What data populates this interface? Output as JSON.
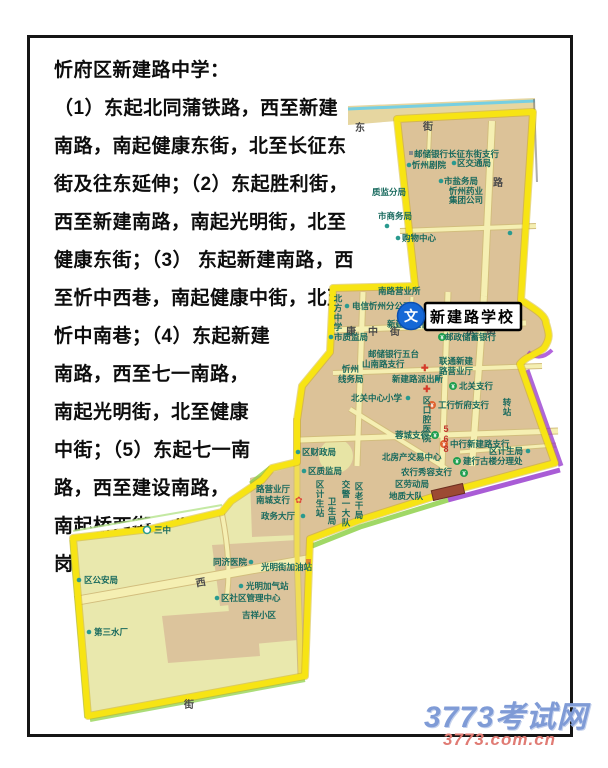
{
  "doc": {
    "lines": [
      "忻府区新建路中学：",
      "（1）东起北同蒲铁路，西至新建",
      "南路，南起健康东街，北至长征东",
      "街及往东延伸；（2）东起胜利街，",
      "西至新建南路，南起光明街，北至",
      "健康东街；（3） 东起新建南路，西",
      "至忻中西巷，南起健康中街，北至",
      "忻中南巷；（4）东起新建",
      "南路，西至七一南路，",
      "南起光明街，北至健康",
      "中街；（5）东起七一南",
      "路，西至建设南路，",
      "南起桥西街，北至龙",
      "岗街。"
    ]
  },
  "map": {
    "school_callout": {
      "icon_char": "文",
      "label": "新建路学校"
    },
    "streets": {
      "dong": "东",
      "jie": "街",
      "lu": "路",
      "kang": "康",
      "zhong": "中",
      "jie2": "街",
      "dong2": "东",
      "jie3": "街",
      "xi": "西",
      "jie_faint": "街",
      "route": "568"
    },
    "icons": {
      "yuan": "¥",
      "cross": "✚",
      "flower": "✿"
    },
    "pois": {
      "p1": "邮储银行长征东街支行",
      "p2": "忻州剧院",
      "p3": "区交通局",
      "p4": "市盐务局",
      "p5": "质监分局",
      "p6a": "忻州药业",
      "p6b": "集团公司",
      "p7": "市商务局",
      "p8": "购物中心",
      "p10": "南路营业所",
      "p11": "电信忻州分公司",
      "p12": "北方中学",
      "p13": "新建路支行",
      "p14": "市质监局",
      "p15a": "邮储银行五台",
      "p15b": "山南路支行",
      "p16a": "忻州",
      "p16b": "线务局",
      "p17a": "联通新建",
      "p17b": "路营业厅",
      "p18": "新建路派出所",
      "p19": "北关支行",
      "p20": "北关中心小学",
      "p21": "区口腔医院",
      "p22": "工行忻府支行",
      "p23": "蓉城支行",
      "p24": "北房产交易中心",
      "p25": "中行新建路支行",
      "p26": "区计生局",
      "p27": "建行古楼分理处",
      "p28": "农行秀容支行",
      "p29": "区劳动局",
      "p30": "地质大队",
      "p31": "区计生站",
      "p32": "卫生局",
      "p33": "交警一大队",
      "p34": "区老干局",
      "p35": "区财政局",
      "p36": "区质监局",
      "p37a": "路营业厅",
      "p37b": "南城支行",
      "p38": "政务大厅",
      "p39": "三中",
      "p40": "区公安局",
      "p41": "第三水厂",
      "p42": "同济医院",
      "p43": "光明街加油站",
      "p44": "光明加气站",
      "p45": "区社区管理中心",
      "p46": "吉祥小区",
      "p47": "邮政储蓄银行",
      "p48": "转站"
    },
    "colors": {
      "boundary": "#f7e414",
      "district_fill": "#dcc298",
      "block_light": "#e9e8ad",
      "road": "#f5efb2",
      "railway_cyan": "#76cfe2",
      "glow_purple": "#9333cc",
      "glow_green": "#8fd14b",
      "poi_teal": "#2a9a8f",
      "school_blue": "#1668d6"
    }
  },
  "watermark": {
    "site": "3773考试网",
    "url": "3773.com.cn"
  }
}
